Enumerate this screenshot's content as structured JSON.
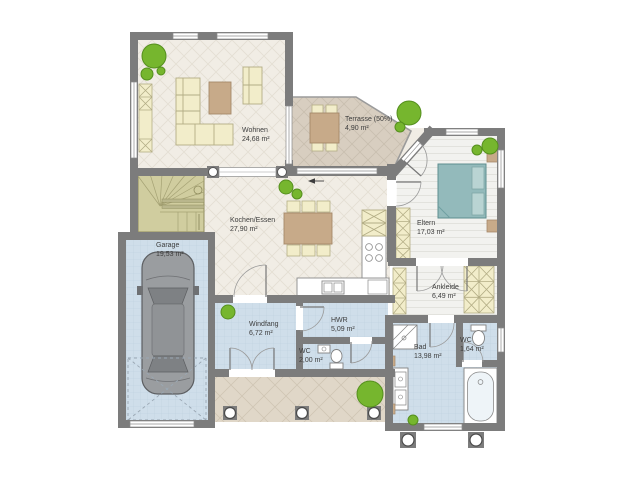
{
  "title": "Erdgeschoss Grundriss",
  "colors": {
    "wall": "#7c7c7c",
    "floor_light": "#f1ede5",
    "floor_terrace": "#d8cec0",
    "floor_tile": "#cfdeea",
    "floor_plank": "#f2f2ef",
    "furn_cream": "#f2edca",
    "furn_brown": "#c7aa89",
    "bed_teal": "#93babb",
    "plant_green": "#76b62e",
    "stairs_olive": "#d0cd9f",
    "car_gray": "#9a9da0",
    "porch": "#e0d7c8"
  },
  "rooms": {
    "wohnen": {
      "label": "Wohnen",
      "area": "24,68 m²"
    },
    "terrasse": {
      "label": "Terrasse (50%)",
      "area": "4,90 m²"
    },
    "kochen_essen": {
      "label": "Kochen/Essen",
      "area": "27,90 m²"
    },
    "eltern": {
      "label": "Eltern",
      "area": "17,03 m²"
    },
    "garage": {
      "label": "Garage",
      "area": "19,53 m²"
    },
    "windfang": {
      "label": "Windfang",
      "area": "6,72 m²"
    },
    "hwr": {
      "label": "HWR",
      "area": "5,09 m²"
    },
    "wc_guest": {
      "label": "WC",
      "area": "2,00 m²"
    },
    "ankleide": {
      "label": "Ankleide",
      "area": "6,49 m²"
    },
    "bad": {
      "label": "Bad",
      "area": "13,98 m²"
    },
    "wc_master": {
      "label": "WC",
      "area": "1,64 m²"
    }
  }
}
